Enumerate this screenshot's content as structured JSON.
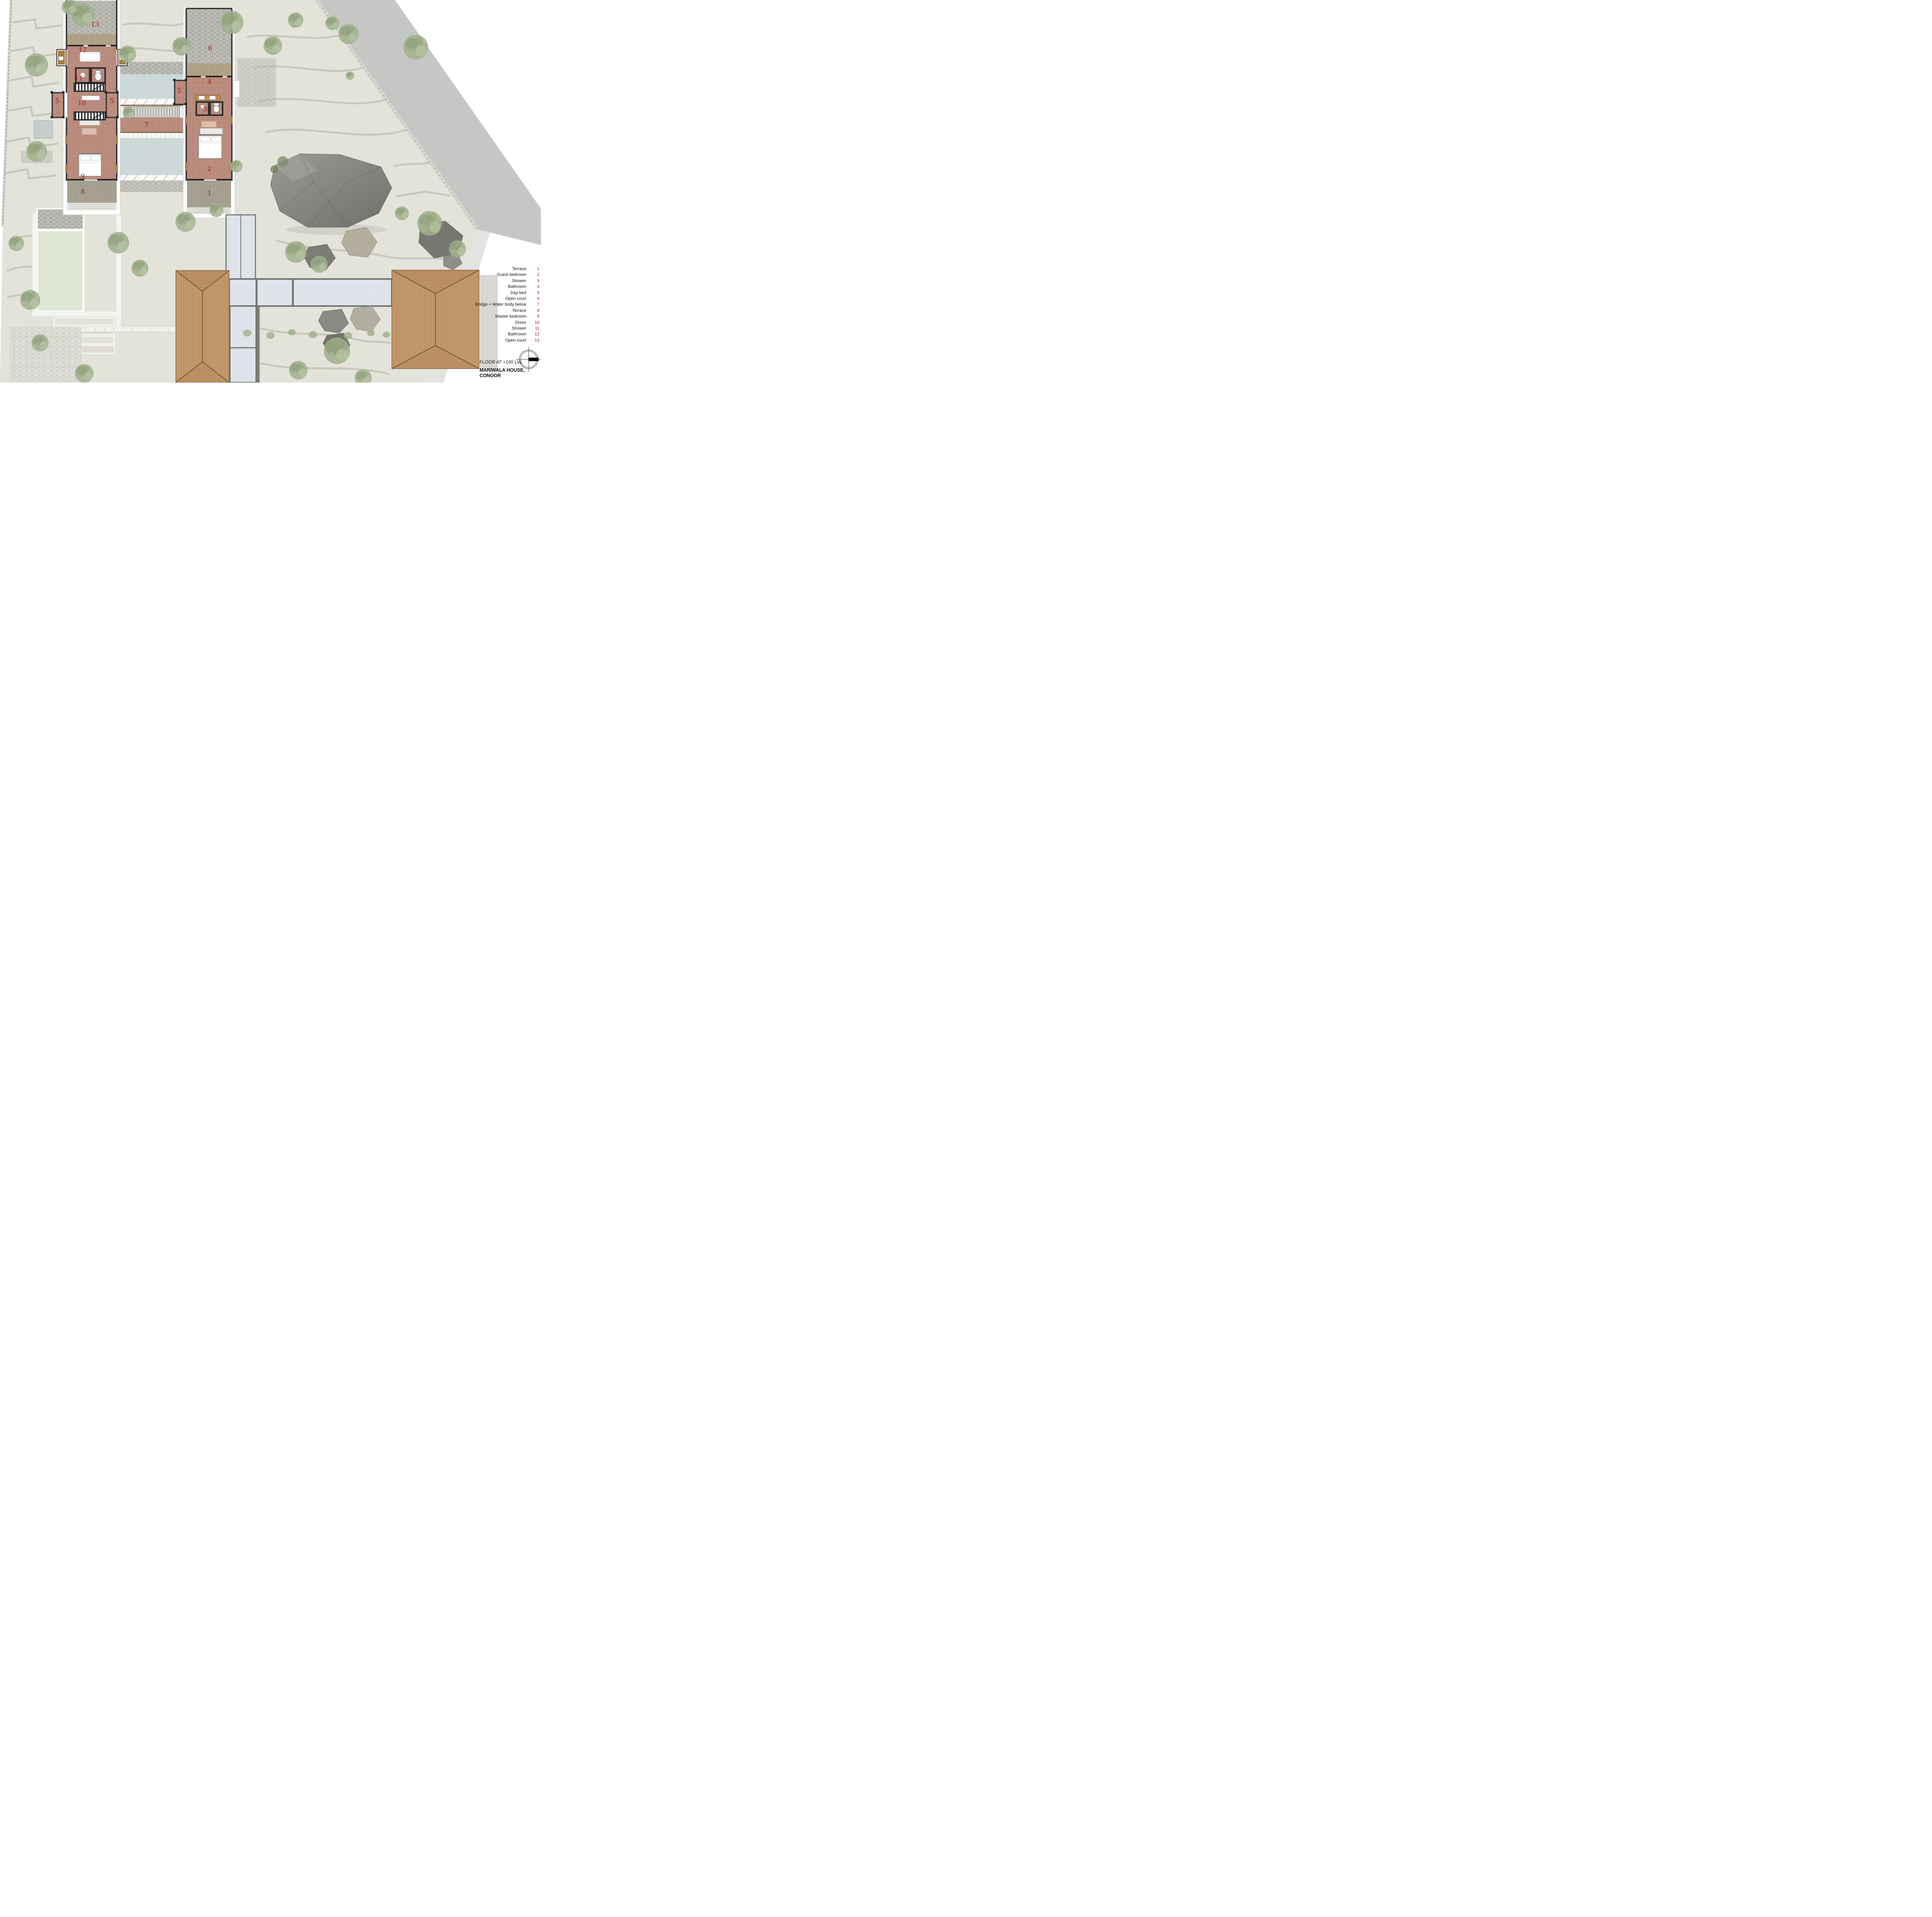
{
  "title_block": {
    "floor_label": "FLOOR AT +100 LVL",
    "project_title": "MARIWALA HOUSE, CONOOR"
  },
  "legend": {
    "items": [
      {
        "label": "Terrace",
        "number": "1"
      },
      {
        "label": "Guest bedroom",
        "number": "2"
      },
      {
        "label": "Shower",
        "number": "3"
      },
      {
        "label": "Bathroom",
        "number": "4"
      },
      {
        "label": "Day bed",
        "number": "5"
      },
      {
        "label": "Open court",
        "number": "6"
      },
      {
        "label": "Bridge + Water body below",
        "number": "7"
      },
      {
        "label": "Terrace",
        "number": "8"
      },
      {
        "label": "Master bedroom",
        "number": "9"
      },
      {
        "label": "Dress",
        "number": "10"
      },
      {
        "label": "Shower",
        "number": "11"
      },
      {
        "label": "Bathroom",
        "number": "12"
      },
      {
        "label": "Open court",
        "number": "13"
      }
    ]
  },
  "markers": [
    {
      "number": "13",
      "room": "Open court"
    },
    {
      "number": "12",
      "room": "Bathroom"
    },
    {
      "number": "11",
      "room": "Shower"
    },
    {
      "number": "5",
      "room": "Day bed"
    },
    {
      "number": "5",
      "room": "Day bed"
    },
    {
      "number": "10",
      "room": "Dress"
    },
    {
      "number": "9",
      "room": "Master bedroom"
    },
    {
      "number": "8",
      "room": "Terrace"
    },
    {
      "number": "6",
      "room": "Open court"
    },
    {
      "number": "5",
      "room": "Day bed"
    },
    {
      "number": "4",
      "room": "Bathroom"
    },
    {
      "number": "3",
      "room": "Shower"
    },
    {
      "number": "7",
      "room": "Bridge + Water body below"
    },
    {
      "number": "2",
      "room": "Guest bedroom"
    },
    {
      "number": "1",
      "room": "Terrace"
    }
  ],
  "palette": {
    "accent_red": "#9e1b21",
    "terrain": "#e3e3da",
    "contour": "#c4c4ba",
    "water": "#cdd9d8",
    "floor_tile": "#b88a7b",
    "wall": "#2a2a2a",
    "roof_wood": "#c2996b",
    "lawn": "#dfe6d6",
    "road": "#c6c6c4",
    "stone_court": "#b7b7b0",
    "skylight": "#e2e6ec"
  }
}
